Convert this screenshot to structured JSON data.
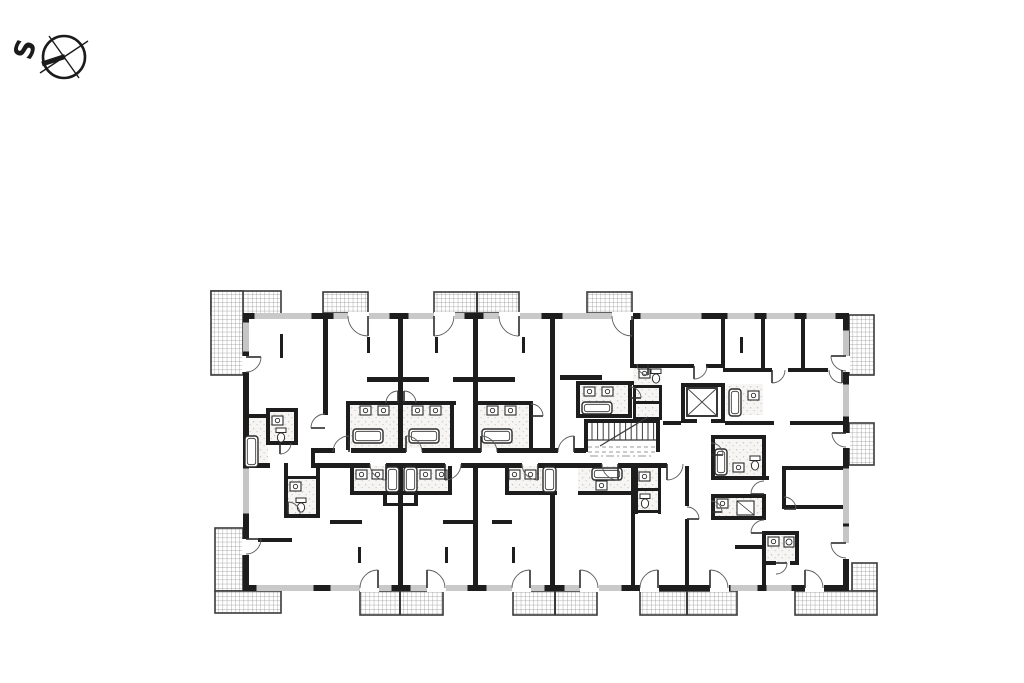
{
  "page": {
    "background": "#ffffff",
    "width": 1024,
    "height": 683
  },
  "compass": {
    "label": "S",
    "cx": 64,
    "cy": 57,
    "r": 21,
    "lines": [
      [
        40,
        73,
        88,
        41
      ],
      [
        49,
        36,
        79,
        78
      ]
    ],
    "needle": [
      42,
      64,
      65,
      56.5
    ]
  },
  "colors": {
    "wall": "#1d1d1d",
    "door_arc": "#5a5a5a",
    "door_leaf": "#2b2b2b",
    "window_line": "#6f6f6f",
    "hatch_line": "#8f8f8f",
    "balcony_border": "#3a3a3a",
    "fixture": "#2b2b2b",
    "speckle_bg": "#f6f5f3",
    "dash": "#9a9a9a"
  },
  "building": {
    "outer": [
      243,
      313,
      606,
      278
    ],
    "wall_thickness": 6
  },
  "balconies": {
    "areas": [
      [
        211,
        291,
        70,
        24
      ],
      [
        211,
        291,
        32,
        84
      ],
      [
        323,
        292,
        45,
        21
      ],
      [
        434,
        292,
        85,
        21
      ],
      [
        587,
        292,
        45,
        21
      ],
      [
        849,
        315,
        25,
        60
      ],
      [
        849,
        423,
        25,
        42
      ],
      [
        852,
        563,
        25,
        28
      ],
      [
        795,
        591,
        82,
        24
      ],
      [
        215,
        528,
        28,
        63
      ],
      [
        215,
        591,
        66,
        22
      ],
      [
        360,
        591,
        83,
        24
      ],
      [
        513,
        591,
        84,
        24
      ],
      [
        640,
        591,
        97,
        24
      ]
    ],
    "dividers": [
      [
        477,
        292,
        477,
        313
      ],
      [
        400,
        591,
        400,
        615
      ],
      [
        555,
        591,
        555,
        615
      ],
      [
        687,
        591,
        687,
        615
      ]
    ]
  },
  "bath_zones": [
    [
      346,
      403,
      104,
      45
    ],
    [
      475,
      403,
      56,
      45
    ],
    [
      576,
      383,
      54,
      33
    ],
    [
      633,
      364,
      28,
      56
    ],
    [
      243,
      416,
      25,
      52
    ],
    [
      266,
      408,
      30,
      35
    ],
    [
      284,
      476,
      34,
      40
    ],
    [
      711,
      437,
      53,
      41
    ],
    [
      711,
      494,
      53,
      24
    ],
    [
      762,
      531,
      35,
      32
    ],
    [
      726,
      384,
      37,
      31
    ],
    [
      350,
      466,
      100,
      27
    ],
    [
      505,
      466,
      52,
      27
    ],
    [
      578,
      466,
      52,
      27
    ],
    [
      635,
      466,
      26,
      46
    ]
  ],
  "walls": [
    [
      243,
      313,
      606,
      6
    ],
    [
      243,
      585,
      606,
      6
    ],
    [
      243,
      313,
      6,
      278
    ],
    [
      843,
      313,
      6,
      278
    ],
    [
      323,
      319,
      5,
      96
    ],
    [
      398,
      319,
      5,
      131
    ],
    [
      473,
      319,
      5,
      131
    ],
    [
      550,
      319,
      5,
      131
    ],
    [
      630,
      319,
      4,
      49
    ],
    [
      721,
      319,
      4,
      49
    ],
    [
      761,
      319,
      4,
      53
    ],
    [
      801,
      319,
      4,
      53
    ],
    [
      367,
      377,
      62,
      5
    ],
    [
      453,
      377,
      62,
      5
    ],
    [
      560,
      375,
      42,
      5
    ],
    [
      630,
      364,
      64,
      4
    ],
    [
      706,
      364,
      19,
      4
    ],
    [
      723,
      368,
      49,
      4
    ],
    [
      788,
      368,
      40,
      4
    ],
    [
      842,
      368,
      5,
      4
    ],
    [
      346,
      401,
      4,
      49
    ],
    [
      346,
      401,
      58,
      4
    ],
    [
      400,
      401,
      56,
      4
    ],
    [
      450,
      401,
      4,
      49
    ],
    [
      475,
      401,
      58,
      4
    ],
    [
      529,
      401,
      4,
      49
    ],
    [
      576,
      381,
      58,
      4
    ],
    [
      576,
      381,
      4,
      37
    ],
    [
      628,
      381,
      4,
      37
    ],
    [
      576,
      414,
      56,
      4
    ],
    [
      633,
      385,
      29,
      3
    ],
    [
      633,
      401,
      29,
      3
    ],
    [
      633,
      417,
      29,
      3
    ],
    [
      633,
      385,
      3,
      35
    ],
    [
      659,
      385,
      3,
      35
    ],
    [
      584,
      419,
      76,
      4
    ],
    [
      584,
      419,
      4,
      33
    ],
    [
      656,
      419,
      4,
      33
    ],
    [
      681,
      383,
      44,
      4
    ],
    [
      681,
      419,
      44,
      4
    ],
    [
      681,
      383,
      4,
      40
    ],
    [
      721,
      383,
      4,
      40
    ],
    [
      313,
      448,
      22,
      5
    ],
    [
      351,
      448,
      55,
      5
    ],
    [
      422,
      448,
      59,
      5
    ],
    [
      497,
      448,
      61,
      5
    ],
    [
      574,
      448,
      12,
      5
    ],
    [
      311,
      448,
      4,
      20
    ],
    [
      313,
      463,
      57,
      5
    ],
    [
      386,
      463,
      59,
      5
    ],
    [
      461,
      463,
      61,
      5
    ],
    [
      538,
      463,
      64,
      5
    ],
    [
      618,
      463,
      49,
      5
    ],
    [
      663,
      421,
      18,
      4
    ],
    [
      725,
      421,
      49,
      4
    ],
    [
      790,
      421,
      57,
      4
    ],
    [
      711,
      435,
      55,
      4
    ],
    [
      711,
      476,
      58,
      4
    ],
    [
      711,
      435,
      4,
      45
    ],
    [
      762,
      437,
      4,
      43
    ],
    [
      711,
      494,
      4,
      26
    ],
    [
      711,
      494,
      55,
      4
    ],
    [
      711,
      516,
      55,
      4
    ],
    [
      762,
      494,
      4,
      24
    ],
    [
      782,
      466,
      4,
      43
    ],
    [
      784,
      466,
      60,
      4
    ],
    [
      784,
      505,
      60,
      4
    ],
    [
      762,
      531,
      37,
      4
    ],
    [
      762,
      561,
      14,
      4
    ],
    [
      790,
      561,
      9,
      4
    ],
    [
      795,
      531,
      4,
      34
    ],
    [
      762,
      533,
      4,
      58
    ],
    [
      398,
      466,
      5,
      119
    ],
    [
      473,
      466,
      5,
      119
    ],
    [
      550,
      466,
      5,
      119
    ],
    [
      631,
      466,
      4,
      119
    ],
    [
      685,
      466,
      4,
      40
    ],
    [
      685,
      519,
      4,
      66
    ],
    [
      350,
      466,
      4,
      28
    ],
    [
      350,
      491,
      54,
      4
    ],
    [
      402,
      491,
      50,
      4
    ],
    [
      448,
      466,
      4,
      28
    ],
    [
      505,
      466,
      4,
      28
    ],
    [
      505,
      491,
      52,
      4
    ],
    [
      578,
      491,
      54,
      4
    ],
    [
      635,
      466,
      3,
      48
    ],
    [
      658,
      466,
      3,
      48
    ],
    [
      635,
      488,
      26,
      3
    ],
    [
      635,
      510,
      26,
      3
    ],
    [
      383,
      491,
      4,
      14
    ],
    [
      414,
      491,
      4,
      14
    ],
    [
      383,
      503,
      35,
      3
    ],
    [
      243,
      414,
      27,
      4
    ],
    [
      266,
      408,
      32,
      4
    ],
    [
      266,
      408,
      4,
      37
    ],
    [
      294,
      408,
      4,
      37
    ],
    [
      266,
      441,
      32,
      4
    ],
    [
      284,
      463,
      4,
      53
    ],
    [
      316,
      466,
      4,
      50
    ],
    [
      284,
      476,
      36,
      3
    ],
    [
      284,
      514,
      36,
      4
    ],
    [
      243,
      463,
      27,
      5
    ],
    [
      330,
      520,
      32,
      4
    ],
    [
      443,
      520,
      35,
      4
    ],
    [
      492,
      520,
      20,
      4
    ],
    [
      258,
      538,
      34,
      4
    ],
    [
      735,
      545,
      30,
      4
    ]
  ],
  "windows": [
    [
      254,
      313,
      58,
      "h"
    ],
    [
      333,
      313,
      57,
      "h"
    ],
    [
      408,
      313,
      57,
      "h"
    ],
    [
      483,
      313,
      59,
      "h"
    ],
    [
      562,
      313,
      60,
      "h"
    ],
    [
      640,
      313,
      62,
      "h"
    ],
    [
      727,
      313,
      28,
      "h"
    ],
    [
      766,
      313,
      29,
      "h"
    ],
    [
      806,
      313,
      30,
      "h"
    ],
    [
      256,
      585,
      58,
      "h"
    ],
    [
      330,
      585,
      62,
      "h"
    ],
    [
      410,
      585,
      58,
      "h"
    ],
    [
      486,
      585,
      59,
      "h"
    ],
    [
      564,
      585,
      58,
      "h"
    ],
    [
      730,
      585,
      28,
      "h"
    ],
    [
      766,
      585,
      26,
      "h"
    ],
    [
      243,
      322,
      30,
      "v"
    ],
    [
      243,
      468,
      46,
      "v"
    ],
    [
      843,
      330,
      42,
      "v"
    ],
    [
      843,
      384,
      33,
      "v"
    ],
    [
      843,
      468,
      56,
      "v"
    ],
    [
      843,
      526,
      32,
      "v"
    ]
  ],
  "door_gaps": [
    [
      348,
      312,
      21,
      8
    ],
    [
      434,
      312,
      21,
      8
    ],
    [
      499,
      312,
      21,
      8
    ],
    [
      612,
      312,
      21,
      8
    ],
    [
      242,
      356,
      8,
      16
    ],
    [
      242,
      539,
      8,
      16
    ],
    [
      842,
      356,
      8,
      16
    ],
    [
      842,
      433,
      8,
      15
    ],
    [
      842,
      543,
      8,
      16
    ],
    [
      360,
      584,
      19,
      8
    ],
    [
      427,
      584,
      19,
      8
    ],
    [
      512,
      584,
      19,
      8
    ],
    [
      580,
      584,
      19,
      8
    ],
    [
      640,
      584,
      19,
      8
    ],
    [
      710,
      584,
      19,
      8
    ],
    [
      805,
      584,
      19,
      8
    ],
    [
      697,
      419,
      14,
      6
    ]
  ],
  "doors": [
    [
      368,
      316,
      20,
      90,
      180
    ],
    [
      434,
      316,
      20,
      90,
      0
    ],
    [
      519,
      316,
      20,
      90,
      180
    ],
    [
      632,
      316,
      20,
      90,
      180
    ],
    [
      246,
      357,
      15,
      0,
      90
    ],
    [
      846,
      356,
      15,
      180,
      90
    ],
    [
      846,
      433,
      14,
      180,
      90
    ],
    [
      846,
      543,
      15,
      180,
      90
    ],
    [
      246,
      539,
      15,
      0,
      90
    ],
    [
      378,
      588,
      18,
      270,
      180
    ],
    [
      427,
      588,
      18,
      270,
      0
    ],
    [
      530,
      588,
      18,
      270,
      180
    ],
    [
      580,
      588,
      18,
      270,
      0
    ],
    [
      658,
      588,
      18,
      270,
      180
    ],
    [
      710,
      588,
      18,
      270,
      0
    ],
    [
      805,
      588,
      18,
      270,
      0
    ],
    [
      349,
      452,
      16,
      270,
      180
    ],
    [
      406,
      452,
      16,
      270,
      0
    ],
    [
      481,
      452,
      16,
      270,
      0
    ],
    [
      574,
      452,
      16,
      270,
      180
    ],
    [
      386,
      464,
      16,
      90,
      180
    ],
    [
      445,
      464,
      16,
      90,
      0
    ],
    [
      538,
      464,
      16,
      90,
      180
    ],
    [
      618,
      464,
      16,
      90,
      180
    ],
    [
      667,
      464,
      16,
      90,
      0
    ],
    [
      325,
      428,
      14,
      180,
      270
    ],
    [
      280,
      443,
      11,
      90,
      0
    ],
    [
      288,
      514,
      12,
      270,
      0
    ],
    [
      398,
      403,
      12,
      270,
      180
    ],
    [
      404,
      403,
      12,
      270,
      0
    ],
    [
      531,
      416,
      12,
      0,
      270
    ],
    [
      630,
      398,
      11,
      0,
      270
    ],
    [
      648,
      364,
      11,
      90,
      180
    ],
    [
      694,
      366,
      13,
      90,
      0
    ],
    [
      772,
      370,
      13,
      90,
      0
    ],
    [
      842,
      370,
      13,
      90,
      180
    ],
    [
      711,
      455,
      12,
      0,
      270
    ],
    [
      711,
      512,
      11,
      0,
      270
    ],
    [
      764,
      494,
      13,
      180,
      270
    ],
    [
      764,
      533,
      13,
      180,
      270
    ],
    [
      687,
      519,
      12,
      0,
      270
    ],
    [
      776,
      563,
      11,
      0,
      90
    ],
    [
      784,
      509,
      12,
      0,
      270
    ]
  ],
  "fixtures": {
    "tubs": [
      [
        353,
        429,
        30,
        14
      ],
      [
        409,
        429,
        30,
        14
      ],
      [
        482,
        429,
        30,
        14
      ],
      [
        582,
        402,
        30,
        12
      ],
      [
        245,
        436,
        13,
        31
      ],
      [
        729,
        389,
        12,
        27
      ],
      [
        715,
        449,
        12,
        26
      ],
      [
        386,
        467,
        13,
        25
      ],
      [
        404,
        467,
        13,
        25
      ],
      [
        543,
        467,
        13,
        25
      ],
      [
        592,
        468,
        30,
        12
      ]
    ],
    "sinks": [
      [
        360,
        406
      ],
      [
        378,
        406
      ],
      [
        412,
        406
      ],
      [
        430,
        406
      ],
      [
        487,
        406
      ],
      [
        505,
        406
      ],
      [
        584,
        387
      ],
      [
        602,
        387
      ],
      [
        639,
        369
      ],
      [
        272,
        416
      ],
      [
        290,
        482
      ],
      [
        356,
        470
      ],
      [
        372,
        470
      ],
      [
        420,
        470
      ],
      [
        436,
        470
      ],
      [
        509,
        470
      ],
      [
        525,
        470
      ],
      [
        596,
        481
      ],
      [
        639,
        472
      ],
      [
        717,
        499
      ],
      [
        733,
        463
      ],
      [
        748,
        391
      ],
      [
        768,
        537
      ]
    ],
    "toilets": [
      [
        276,
        428
      ],
      [
        296,
        498
      ],
      [
        640,
        494
      ],
      [
        750,
        456
      ],
      [
        651,
        369
      ]
    ],
    "showers": [
      [
        737,
        501,
        17,
        14
      ]
    ],
    "washers": [
      [
        784,
        537
      ]
    ],
    "ticks": [
      [
        280,
        334,
        24
      ],
      [
        367,
        337,
        16
      ],
      [
        435,
        337,
        16
      ],
      [
        522,
        337,
        16
      ],
      [
        740,
        337,
        16
      ],
      [
        358,
        547,
        16
      ],
      [
        445,
        547,
        16
      ],
      [
        512,
        547,
        16
      ]
    ]
  },
  "stairs": {
    "frame": [
      588,
      423,
      68,
      18
    ],
    "tread_x1": 592,
    "tread_x2": 654,
    "tread_step": 5.6,
    "tread_y1": 423,
    "tread_y2": 440,
    "landing_y": 440,
    "break_line": [
      600,
      446,
      648,
      417
    ],
    "dashes": [
      [
        588,
        447,
        656,
        447
      ],
      [
        588,
        452,
        656,
        452
      ]
    ]
  },
  "elevator": {
    "cab": [
      687,
      388,
      30,
      28
    ]
  },
  "corridor_dashes": [
    [
      590,
      456,
      654,
      456
    ]
  ]
}
